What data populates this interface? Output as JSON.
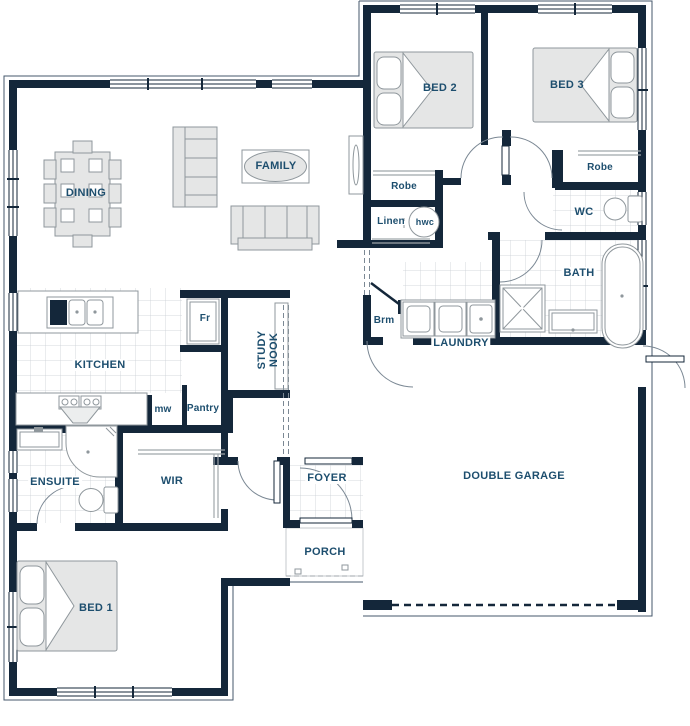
{
  "colors": {
    "wall": "#14273a",
    "label": "#1d4e6e",
    "furniture_stroke": "#8f979c",
    "furniture_fill": "#e5e6e6",
    "tile_line": "#c9ced3",
    "arc": "#7b8894",
    "outline": "#44576b"
  },
  "labels": {
    "bed1": "BED 1",
    "bed2": "BED 2",
    "bed3": "BED 3",
    "dining": "DINING",
    "family": "FAMILY",
    "kitchen": "KITCHEN",
    "study_line1": "STUDY",
    "study_line2": "NOOK",
    "fridge": "Fr",
    "microwave": "mw",
    "pantry": "Pantry",
    "robe_bed2": "Robe",
    "robe_bed3": "Robe",
    "linen": "Linen",
    "hot_water": "hwc",
    "wc": "WC",
    "bath": "BATH",
    "broom": "Brm",
    "laundry": "LAUNDRY",
    "ensuite": "ENSUITE",
    "wir": "WIR",
    "foyer": "FOYER",
    "porch": "PORCH",
    "garage": "DOUBLE GARAGE"
  }
}
